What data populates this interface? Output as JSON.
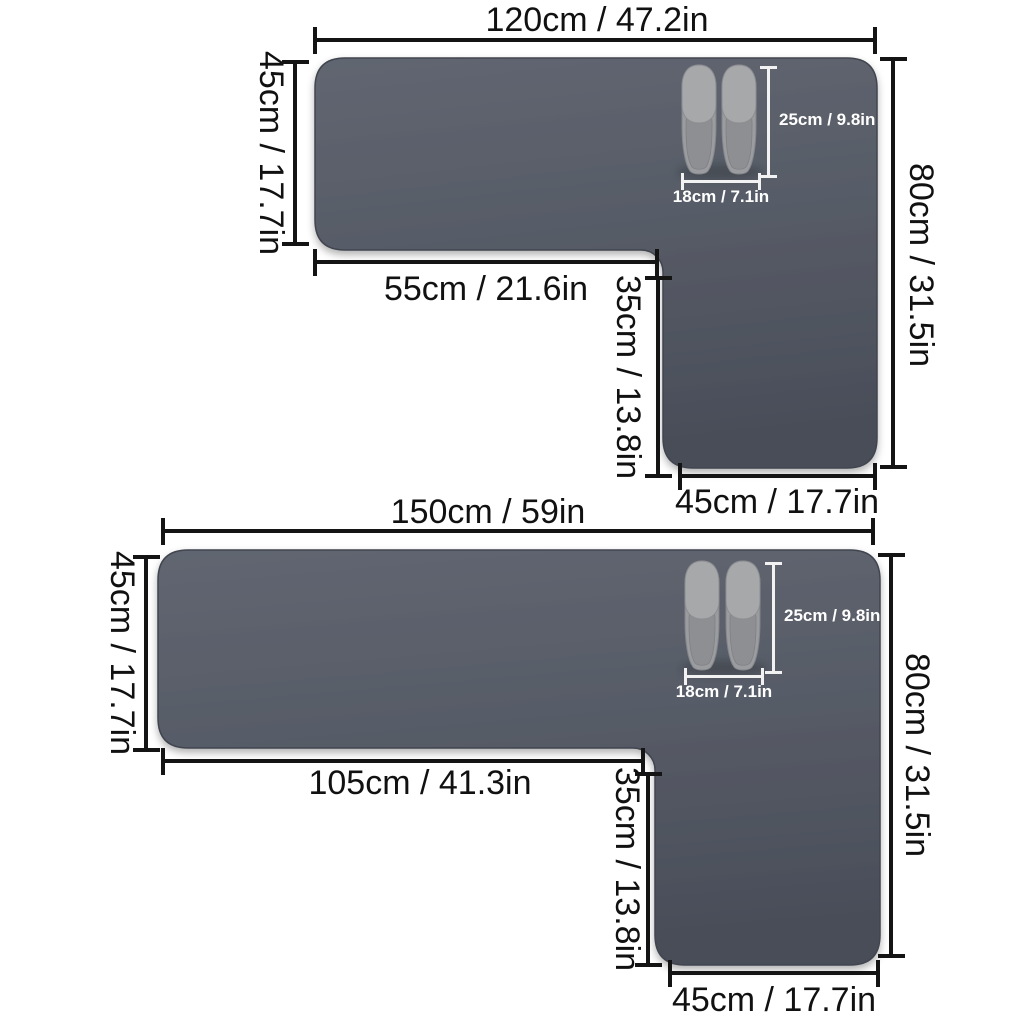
{
  "colors": {
    "background": "#ffffff",
    "mat_top": "#616671",
    "mat_mid": "#565b66",
    "mat_bottom": "#4a4e59",
    "mat_outline": "#3f434d",
    "dimension_line": "#141414",
    "dimension_text": "#111111",
    "slipper_scale_line": "#f2f2f2",
    "slipper_scale_text": "#ffffff",
    "slipper_upper": "#a7a8aa",
    "slipper_sole": "#9b9c9f",
    "slipper_insole": "#8e8f93"
  },
  "mats": [
    {
      "dimensions": {
        "top_width": "120cm / 47.2in",
        "left_height": "45cm / 17.7in",
        "inner_width": "55cm / 21.6in",
        "inner_height": "35cm / 13.8in",
        "right_height": "80cm / 31.5in",
        "bottom_width": "45cm / 17.7in"
      },
      "slipper_scale": {
        "length": "25cm / 9.8in",
        "width": "18cm / 7.1in"
      }
    },
    {
      "dimensions": {
        "top_width": "150cm / 59in",
        "left_height": "45cm / 17.7in",
        "inner_width": "105cm / 41.3in",
        "inner_height": "35cm / 13.8in",
        "right_height": "80cm / 31.5in",
        "bottom_width": "45cm / 17.7in"
      },
      "slipper_scale": {
        "length": "25cm / 9.8in",
        "width": "18cm / 7.1in"
      }
    }
  ]
}
